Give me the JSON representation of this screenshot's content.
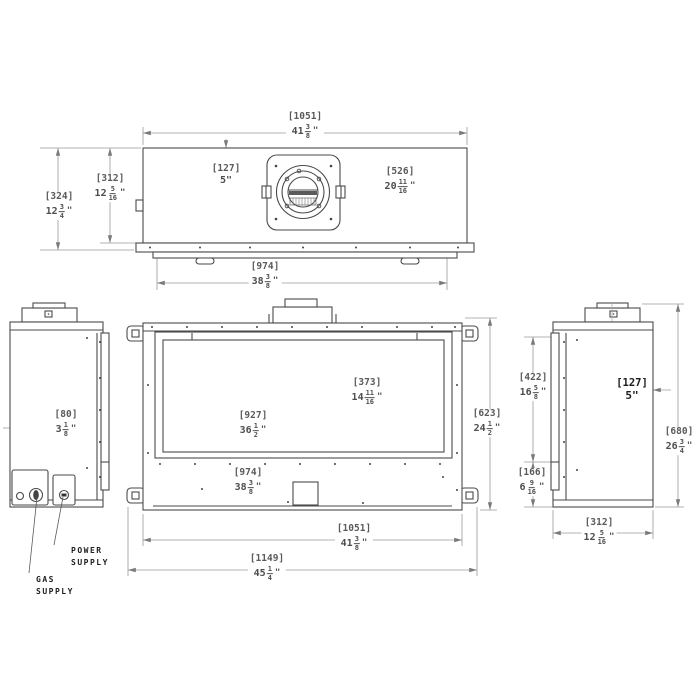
{
  "sym": {
    "inch": "\""
  },
  "dims": {
    "d1051": {
      "mm": "[1051]",
      "w": "41",
      "n": "3",
      "d": "8"
    },
    "d127": {
      "mm": "[127]",
      "plain": "5\""
    },
    "d526": {
      "mm": "[526]",
      "w": "20",
      "n": "11",
      "d": "16"
    },
    "d324": {
      "mm": "[324]",
      "w": "12",
      "n": "3",
      "d": "4"
    },
    "d312": {
      "mm": "[312]",
      "w": "12",
      "n": "5",
      "d": "16"
    },
    "d974": {
      "mm": "[974]",
      "w": "38",
      "n": "3",
      "d": "8"
    },
    "d373": {
      "mm": "[373]",
      "w": "14",
      "n": "11",
      "d": "16"
    },
    "d927": {
      "mm": "[927]",
      "w": "36",
      "n": "1",
      "d": "2"
    },
    "d623": {
      "mm": "[623]",
      "w": "24",
      "n": "1",
      "d": "2"
    },
    "d1149": {
      "mm": "[1149]",
      "w": "45",
      "n": "1",
      "d": "4"
    },
    "d80": {
      "mm": "[80]",
      "w": "3",
      "n": "1",
      "d": "8"
    },
    "d422": {
      "mm": "[422]",
      "w": "16",
      "n": "5",
      "d": "8"
    },
    "d166": {
      "mm": "[166]",
      "w": "6",
      "n": "9",
      "d": "16"
    },
    "d680": {
      "mm": "[680]",
      "w": "26",
      "n": "3",
      "d": "4"
    }
  },
  "labels": {
    "gas": [
      "GAS",
      "SUPPLY"
    ],
    "power": [
      "POWER",
      "SUPPLY"
    ]
  },
  "colors": {
    "geometry": "#4a4a4a",
    "dimension_lines": "#999999",
    "text": "#4d4d4d"
  }
}
